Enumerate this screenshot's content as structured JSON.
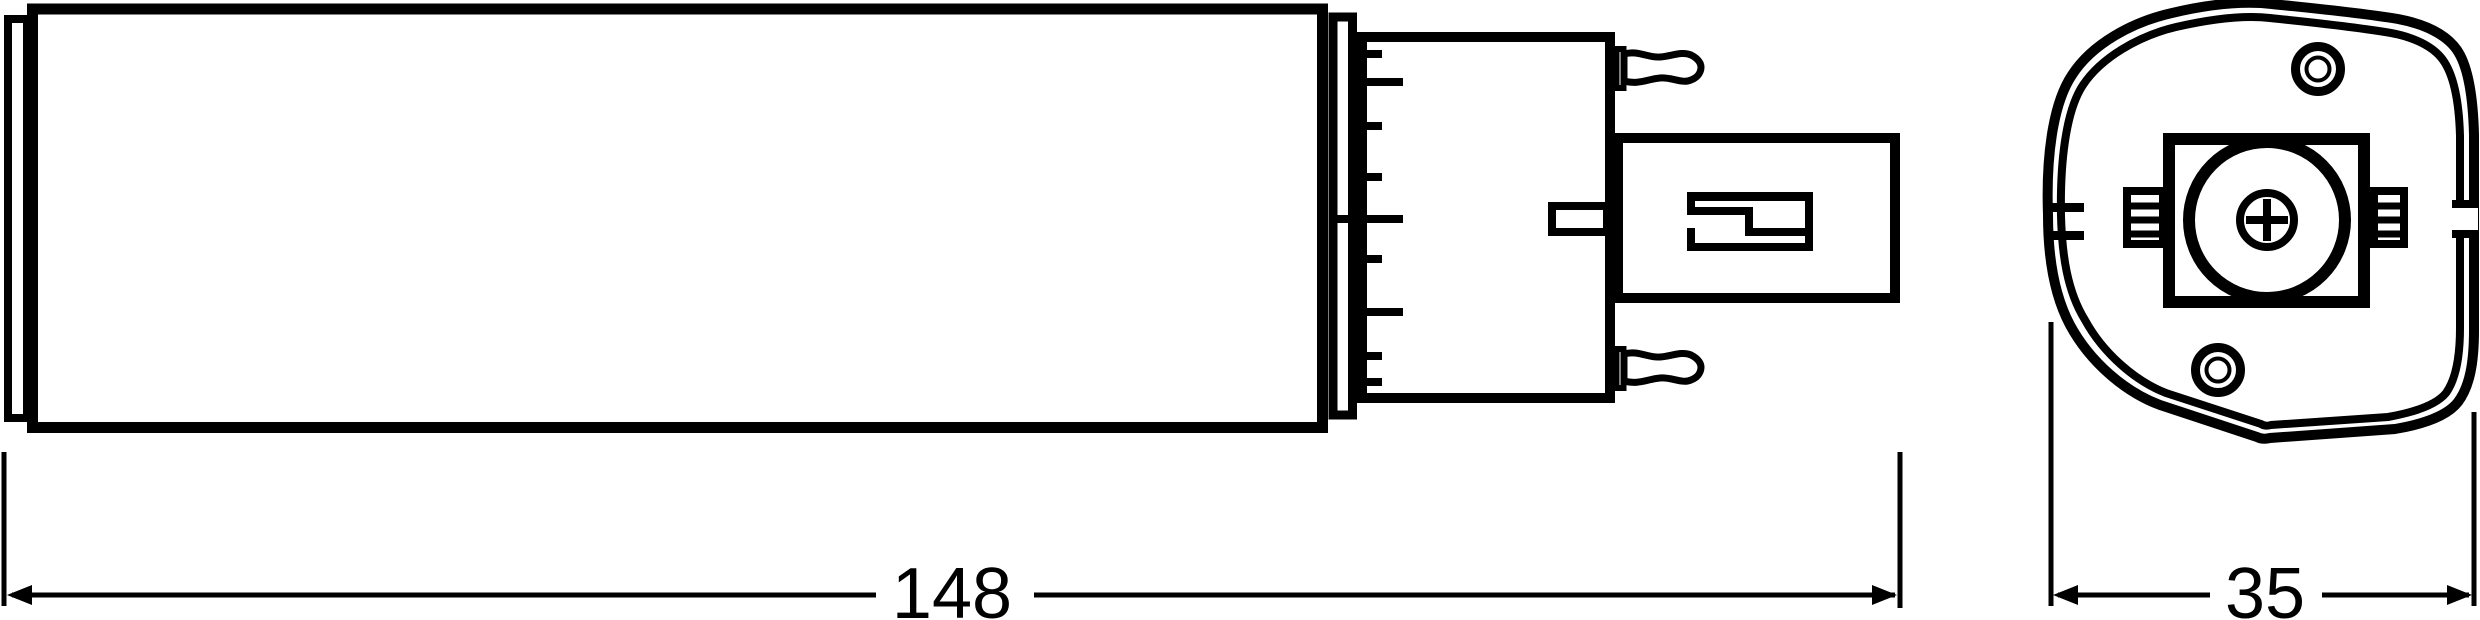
{
  "dimensions": {
    "length": {
      "value": "148"
    },
    "width": {
      "value": "35"
    }
  },
  "colors": {
    "line": "#000000",
    "background": "#ffffff"
  }
}
